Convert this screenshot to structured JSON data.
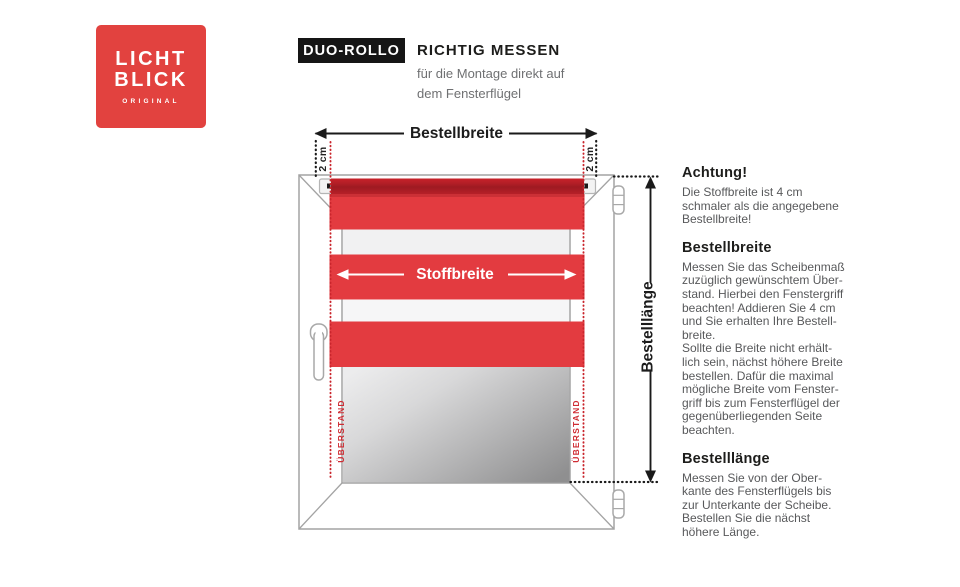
{
  "logo": {
    "line1": "LICHT",
    "line2": "BLICK",
    "subtext": "ORIGINAL"
  },
  "header": {
    "badge": "DUO-ROLLO",
    "title": "RICHTIG MESSEN",
    "subtitle_lines": [
      "für die Montage direkt auf",
      "dem Fensterflügel"
    ]
  },
  "diagram": {
    "labels": {
      "bestellbreite": "Bestellbreite",
      "stoffbreite": "Stoffbreite",
      "bestelllaenge": "Bestelllänge",
      "offset_left": "2 cm",
      "offset_right": "2 cm",
      "ueberstand_left": "ÜBERSTAND",
      "ueberstand_right": "ÜBERSTAND"
    },
    "colors": {
      "fabric_red": "#e33b40",
      "tube_red": "#a51b23",
      "logo_red": "#e2423f",
      "dotted_red": "#c9252c",
      "dotted_black": "#1a1a1a",
      "frame_gray": "#a3a3a3"
    }
  },
  "right_column": {
    "sections": [
      {
        "heading": "Achtung!",
        "lines": [
          "Die Stoffbreite ist 4 cm",
          "schmaler als die angegebene",
          "Bestellbreite!"
        ]
      },
      {
        "heading": "Bestellbreite",
        "lines": [
          "Messen Sie das Scheibenmaß",
          "zuzüglich gewünschtem Über-",
          "stand. Hierbei den Fenstergriff",
          "beachten! Addieren Sie 4 cm",
          "und Sie erhalten Ihre Bestell-",
          "breite.",
          "Sollte die Breite nicht erhält-",
          "lich sein, nächst höhere Breite",
          "bestellen. Dafür die maximal",
          "mögliche Breite vom Fenster-",
          "griff bis zum Fensterflügel der",
          "gegenüberliegenden Seite",
          "beachten."
        ]
      },
      {
        "heading": "Bestelllänge",
        "lines": [
          "Messen Sie von der Ober-",
          "kante des Fensterflügels bis",
          "zur Unterkante der Scheibe.",
          "Bestellen Sie die nächst",
          "höhere Länge."
        ]
      }
    ]
  }
}
